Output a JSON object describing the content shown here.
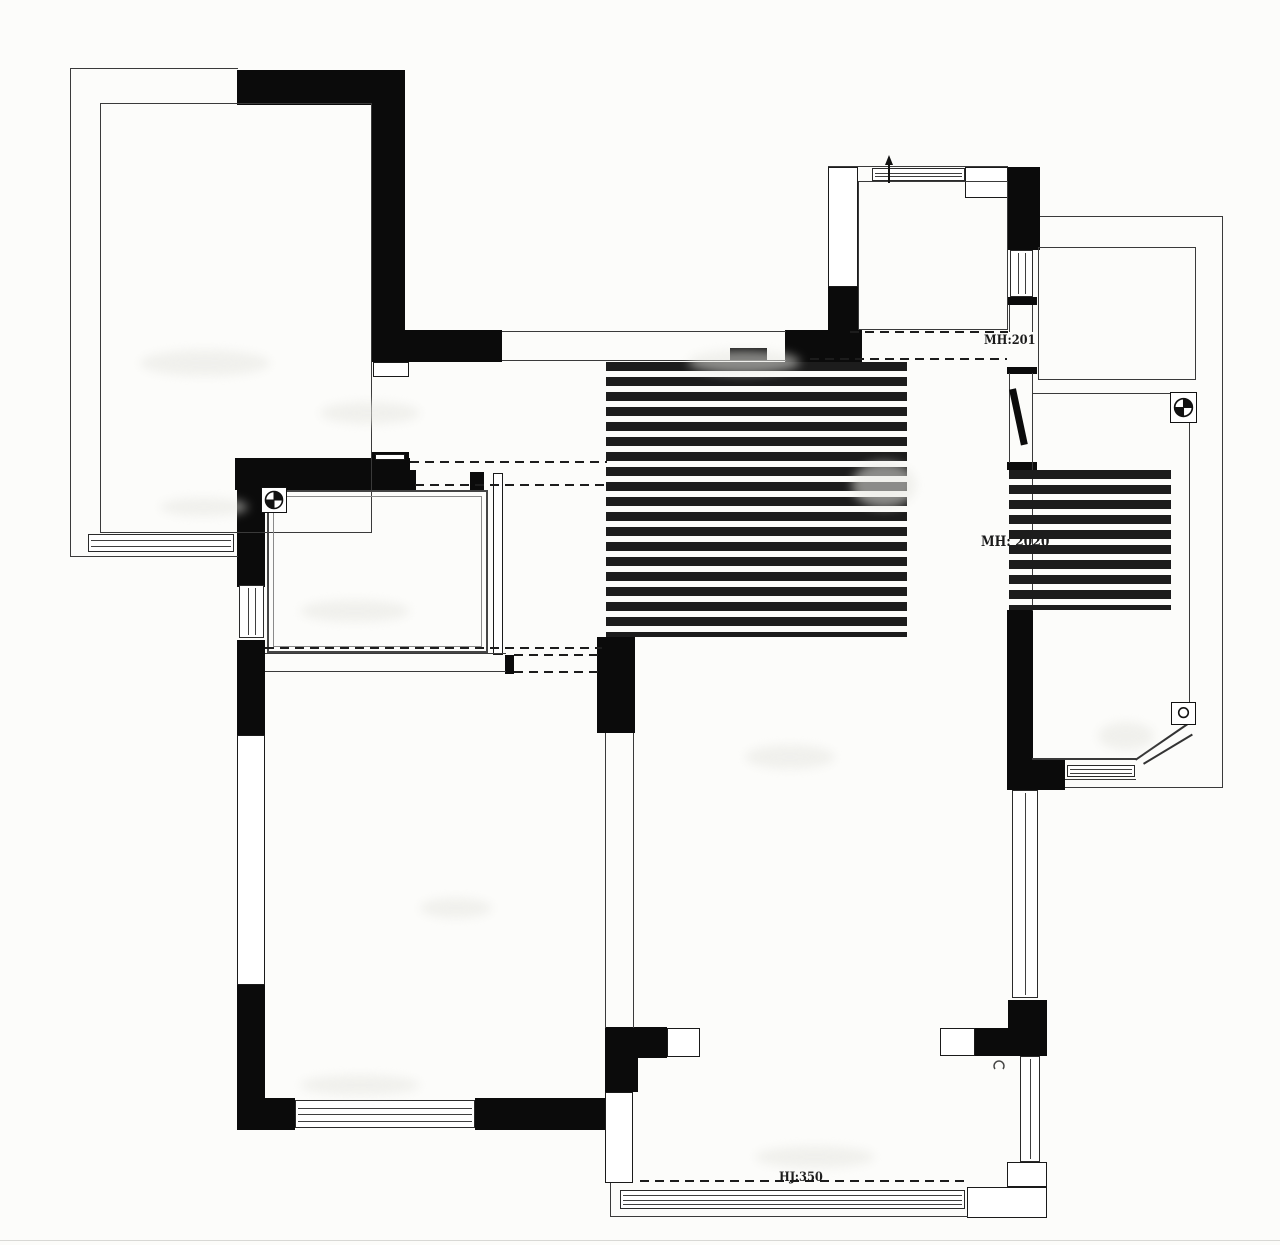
{
  "annotations": {
    "kitchen_door": "MH:201",
    "balcony_door": "MH: 2020",
    "rail_height": "HJ:350"
  },
  "colors": {
    "wall": "#0b0b0b",
    "thin_line": "#3a3a3a",
    "dashed_line": "#1c1c1c",
    "background": "#fcfcfa",
    "text": "#1a1a1a"
  },
  "geometry": {
    "walls": [
      {
        "n": "terrace-top-wall",
        "r": [
          237,
          70,
          168,
          35
        ]
      },
      {
        "n": "terrace-right-wall",
        "r": [
          372,
          70,
          33,
          262
        ]
      },
      {
        "n": "entry-wall-west",
        "r": [
          372,
          330,
          130,
          32
        ]
      },
      {
        "n": "entry-wall-east",
        "r": [
          785,
          330,
          77,
          32
        ]
      },
      {
        "n": "kitchen-west-wall-lower",
        "r": [
          828,
          285,
          30,
          47
        ]
      },
      {
        "n": "kitchen-east-wall-upper",
        "r": [
          1008,
          167,
          32,
          83
        ]
      },
      {
        "n": "kitchen-east-jamb",
        "r": [
          1007,
          297,
          30,
          8
        ]
      },
      {
        "n": "hall-east-jamb-upper",
        "r": [
          1007,
          367,
          30,
          7
        ]
      },
      {
        "n": "hall-east-jamb-lower",
        "r": [
          1007,
          462,
          30,
          8
        ]
      },
      {
        "n": "hall-east-wall",
        "r": [
          1007,
          610,
          26,
          148
        ]
      },
      {
        "n": "right-balcony-south-wall",
        "r": [
          1007,
          758,
          58,
          32
        ]
      },
      {
        "n": "hall-southeast-column",
        "r": [
          1008,
          1000,
          39,
          56
        ]
      },
      {
        "n": "hall-south-wall-east",
        "r": [
          975,
          1028,
          33,
          28
        ]
      },
      {
        "n": "hall-south-wall-west",
        "r": [
          605,
          1027,
          62,
          31
        ]
      },
      {
        "n": "south-room-west-wall-upper",
        "r": [
          605,
          1058,
          33,
          34
        ]
      },
      {
        "n": "study-north-wall",
        "r": [
          235,
          458,
          175,
          32
        ]
      },
      {
        "n": "study-north-track",
        "r": [
          371,
          452,
          38,
          10
        ]
      },
      {
        "n": "study-west-wall-upper",
        "r": [
          237,
          460,
          28,
          127
        ]
      },
      {
        "n": "study-west-wall-lower",
        "r": [
          237,
          640,
          28,
          95
        ]
      },
      {
        "n": "bedroom-west-wall-lower",
        "r": [
          237,
          985,
          28,
          145
        ]
      },
      {
        "n": "bedroom-south-wall-west",
        "r": [
          237,
          1098,
          58,
          32
        ]
      },
      {
        "n": "bedroom-south-wall-east",
        "r": [
          475,
          1098,
          133,
          32
        ]
      },
      {
        "n": "center-pillar",
        "r": [
          597,
          637,
          38,
          96
        ]
      },
      {
        "n": "study-door-jamb-east",
        "r": [
          470,
          472,
          14,
          18
        ]
      },
      {
        "n": "study-door-jamb-west",
        "r": [
          407,
          470,
          9,
          20
        ]
      },
      {
        "n": "bedroom-door-jamb",
        "r": [
          505,
          655,
          9,
          19
        ]
      },
      {
        "n": "entry-door-stop",
        "r": [
          730,
          348,
          37,
          13
        ]
      }
    ],
    "blocks": [
      {
        "n": "entry-threshold",
        "r": [
          373,
          362,
          36,
          15
        ]
      },
      {
        "n": "kitchen-west-wall-upper",
        "r": [
          828,
          167,
          30,
          120
        ]
      },
      {
        "n": "kitchen-north-corner",
        "r": [
          965,
          167,
          43,
          31
        ]
      },
      {
        "n": "hall-opening-jamb-west",
        "r": [
          667,
          1028,
          33,
          29
        ]
      },
      {
        "n": "hall-opening-jamb-east",
        "r": [
          940,
          1028,
          35,
          28
        ]
      },
      {
        "n": "south-room-west-column",
        "r": [
          605,
          1092,
          28,
          91
        ]
      },
      {
        "n": "south-room-corner-step-upper",
        "r": [
          1007,
          1162,
          40,
          25
        ]
      },
      {
        "n": "south-room-corner-step-lower",
        "r": [
          967,
          1187,
          80,
          31
        ]
      },
      {
        "n": "bedroom-west-window-bay",
        "r": [
          237,
          735,
          28,
          250
        ],
        "bw": 1
      },
      {
        "n": "study-track-slot",
        "r": [
          375,
          454,
          30,
          6
        ],
        "bw": 1
      },
      {
        "n": "study-east-panel",
        "r": [
          493,
          473,
          10,
          182
        ],
        "bw": 1
      }
    ],
    "lines": [
      {
        "n": "terrace-outer-west",
        "r": [
          70,
          68,
          1,
          489
        ]
      },
      {
        "n": "terrace-outer-north",
        "r": [
          70,
          68,
          168,
          1
        ]
      },
      {
        "n": "terrace-outer-south",
        "r": [
          70,
          556,
          168,
          1
        ]
      },
      {
        "n": "kitchen-outer-north",
        "r": [
          828,
          166,
          180,
          1
        ]
      },
      {
        "n": "east-wing-outer-north",
        "r": [
          1040,
          216,
          183,
          1
        ]
      },
      {
        "n": "east-wing-outer-east",
        "r": [
          1222,
          216,
          1,
          572
        ]
      },
      {
        "n": "east-wing-outer-south",
        "r": [
          1065,
          787,
          158,
          1
        ]
      },
      {
        "n": "entry-opening-north",
        "r": [
          502,
          331,
          284,
          1
        ]
      },
      {
        "n": "entry-opening-south",
        "r": [
          502,
          360,
          284,
          1
        ]
      },
      {
        "n": "kitchen-jamb-line-w",
        "r": [
          1009,
          305,
          1,
          27
        ]
      },
      {
        "n": "kitchen-jamb-line-e",
        "r": [
          1032,
          305,
          1,
          27
        ]
      },
      {
        "n": "balcony-door-frame-w",
        "r": [
          1009,
          373,
          1,
          90
        ]
      },
      {
        "n": "balcony-door-frame-e",
        "r": [
          1032,
          373,
          1,
          90
        ]
      },
      {
        "n": "bedroom-north-wall-upper",
        "r": [
          265,
          653,
          241,
          1
        ]
      },
      {
        "n": "bedroom-north-wall-lower",
        "r": [
          265,
          671,
          241,
          1
        ]
      },
      {
        "n": "bedroom-east-wall-w",
        "r": [
          605,
          733,
          1,
          295
        ]
      },
      {
        "n": "bedroom-east-wall-e",
        "r": [
          633,
          733,
          1,
          295
        ]
      },
      {
        "n": "bath-west-edge",
        "r": [
          1032,
          393,
          1,
          218
        ]
      },
      {
        "n": "bath-north-edge",
        "r": [
          1032,
          393,
          158,
          1
        ]
      },
      {
        "n": "bath-east-edge",
        "r": [
          1189,
          393,
          1,
          330
        ]
      },
      {
        "n": "bath-south-edge",
        "r": [
          1032,
          758,
          104,
          2
        ]
      },
      {
        "n": "bath-window-sill",
        "r": [
          1065,
          779,
          71,
          1
        ]
      },
      {
        "n": "south-room-outer-west",
        "r": [
          610,
          1183,
          1,
          34
        ]
      },
      {
        "n": "south-room-outer-south",
        "r": [
          610,
          1216,
          358,
          1
        ]
      },
      {
        "n": "page-edge",
        "r": [
          0,
          1240,
          1280,
          1
        ],
        "c": "#d8d8d5"
      }
    ],
    "rects": [
      {
        "n": "terrace-inner",
        "r": [
          100,
          103,
          272,
          430
        ]
      },
      {
        "n": "kitchen-inner",
        "r": [
          858,
          181,
          150,
          149
        ]
      },
      {
        "n": "kitchen-balcony",
        "r": [
          1038,
          247,
          158,
          133
        ]
      },
      {
        "n": "study-inner-outer",
        "r": [
          267,
          490,
          221,
          163
        ],
        "bw": 2,
        "c": "#454545"
      },
      {
        "n": "study-inner-inner",
        "r": [
          273,
          496,
          209,
          151
        ],
        "c": "#8a8a8a"
      }
    ],
    "dash_h": [
      {
        "n": "mh201-dash-n",
        "r": [
          850,
          331,
          158
        ]
      },
      {
        "n": "mh201-dash-s",
        "r": [
          810,
          358,
          197
        ]
      },
      {
        "n": "study-dash-n",
        "r": [
          410,
          461,
          197
        ]
      },
      {
        "n": "study-dash-s",
        "r": [
          415,
          484,
          192
        ]
      },
      {
        "n": "bedroom-opening-dash-n",
        "r": [
          514,
          654,
          84
        ]
      },
      {
        "n": "bedroom-opening-dash-s",
        "r": [
          514,
          671,
          84
        ]
      },
      {
        "n": "study-south-dash",
        "r": [
          265,
          647,
          337
        ]
      },
      {
        "n": "hj350-dash",
        "r": [
          640,
          1180,
          325
        ]
      }
    ],
    "dash_v": [
      {
        "n": "hall-axis-dash-w",
        "r": [
          606,
          362,
          275
        ]
      },
      {
        "n": "hall-axis-dash-e",
        "r": [
          632,
          362,
          275
        ]
      },
      {
        "n": "mh2020-dash-w",
        "r": [
          1009,
          470,
          140
        ]
      },
      {
        "n": "mh2020-dash-e",
        "r": [
          1031,
          470,
          140
        ]
      }
    ],
    "windows_h": [
      {
        "n": "terrace-south-window",
        "r": [
          88,
          534,
          146,
          18
        ],
        "k": 2
      },
      {
        "n": "kitchen-north-window",
        "r": [
          872,
          168,
          93,
          13
        ],
        "k": 2
      },
      {
        "n": "bath-south-window",
        "r": [
          1067,
          765,
          68,
          12
        ],
        "k": 2
      },
      {
        "n": "bedroom-south-window",
        "r": [
          295,
          1100,
          180,
          28
        ],
        "k": 3
      },
      {
        "n": "south-room-window",
        "r": [
          620,
          1190,
          345,
          19
        ],
        "k": 3
      }
    ],
    "windows_v": [
      {
        "n": "kitchen-east-window",
        "r": [
          1010,
          250,
          23,
          47
        ],
        "k": 2
      },
      {
        "n": "study-west-window",
        "r": [
          239,
          585,
          25,
          53
        ],
        "k": 2
      },
      {
        "n": "hall-east-window",
        "r": [
          1012,
          790,
          26,
          208
        ],
        "k": 1
      },
      {
        "n": "south-room-east-window",
        "r": [
          1020,
          1056,
          20,
          106
        ],
        "k": 1
      }
    ],
    "diagonals": [
      {
        "n": "bath-chamfer-a",
        "x": 1135,
        "y": 759,
        "len": 67,
        "deg": -34.5
      },
      {
        "n": "bath-chamfer-b",
        "x": 1143,
        "y": 763,
        "len": 57,
        "deg": -31
      }
    ],
    "leaves": [
      {
        "n": "balcony-door-leaf",
        "r": [
          1009,
          389,
          7,
          57
        ],
        "deg": -12
      }
    ],
    "symbols": [
      {
        "n": "study-datum-symbol",
        "r": [
          261,
          487,
          26,
          26
        ],
        "kind": "quad"
      },
      {
        "n": "bath-datum-symbol",
        "r": [
          1170,
          392,
          27,
          31
        ],
        "kind": "quad"
      },
      {
        "n": "bath-drain-symbol",
        "r": [
          1171,
          702,
          25,
          23
        ],
        "kind": "circ"
      },
      {
        "n": "kitchen-window-arrow",
        "r": [
          883,
          155,
          12,
          28
        ],
        "kind": "arrow"
      },
      {
        "n": "hall-knob-mark",
        "r": [
          992,
          1058,
          14,
          14
        ],
        "kind": "arc"
      }
    ],
    "smudges": [
      {
        "n": "faded-label",
        "r": [
          140,
          350,
          130,
          26
        ]
      },
      {
        "n": "faded-label",
        "r": [
          320,
          402,
          100,
          22
        ]
      },
      {
        "n": "faded-label",
        "r": [
          688,
          350,
          112,
          24
        ]
      },
      {
        "n": "faded-label",
        "r": [
          160,
          498,
          88,
          18
        ]
      },
      {
        "n": "faded-label",
        "r": [
          300,
          600,
          110,
          22
        ]
      },
      {
        "n": "faded-label",
        "r": [
          852,
          462,
          64,
          46
        ]
      },
      {
        "n": "faded-label",
        "r": [
          745,
          745,
          90,
          24
        ]
      },
      {
        "n": "faded-label",
        "r": [
          420,
          898,
          72,
          20
        ]
      },
      {
        "n": "faded-label",
        "r": [
          755,
          1146,
          120,
          22
        ]
      },
      {
        "n": "faded-label",
        "r": [
          1098,
          722,
          56,
          28
        ]
      },
      {
        "n": "faded-label",
        "r": [
          300,
          1075,
          120,
          20
        ]
      }
    ]
  }
}
